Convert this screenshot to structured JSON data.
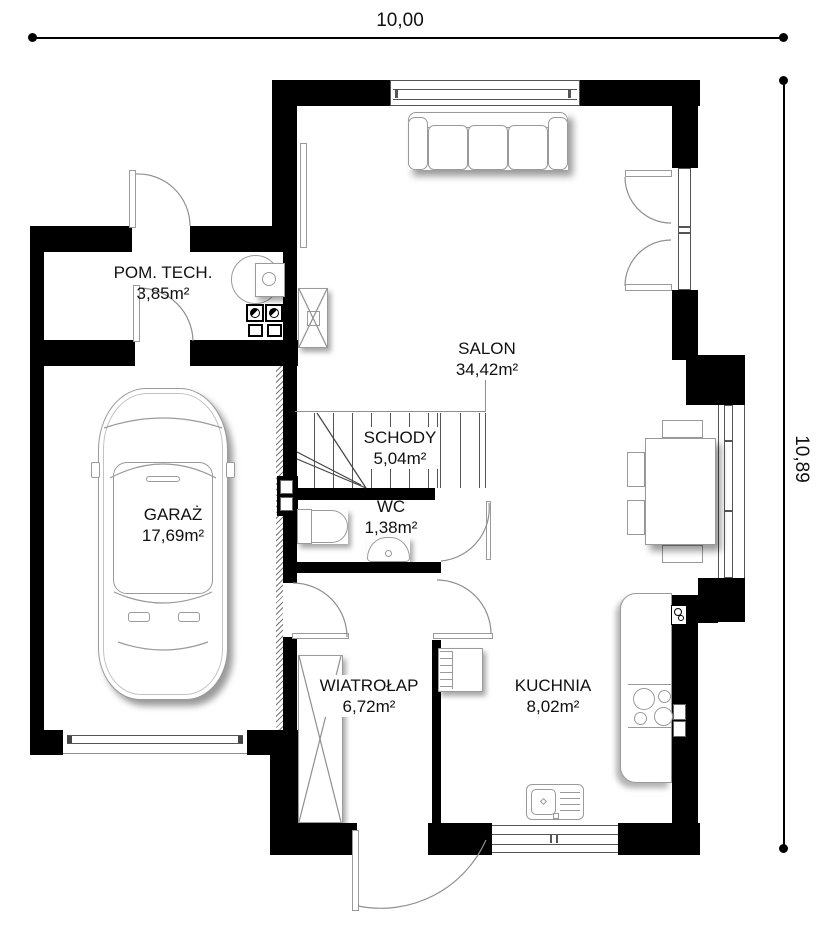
{
  "dimensions": {
    "width_label": "10,00",
    "height_label": "10,89"
  },
  "rooms": {
    "pom_tech": {
      "name": "POM. TECH.",
      "area": "3,85m²"
    },
    "garaz": {
      "name": "GARAŻ",
      "area": "17,69m²"
    },
    "salon": {
      "name": "SALON",
      "area": "34,42m²"
    },
    "schody": {
      "name": "SCHODY",
      "area": "5,04m²"
    },
    "wc": {
      "name": "WC",
      "area": "1,38m²"
    },
    "wiatrolap": {
      "name": "WIATROŁAP",
      "area": "6,72m²"
    },
    "kuchnia": {
      "name": "KUCHNIA",
      "area": "8,02m²"
    }
  },
  "colors": {
    "wall": "#000000",
    "furniture_line": "#9a9a9a",
    "background": "#ffffff",
    "text": "#111111"
  }
}
